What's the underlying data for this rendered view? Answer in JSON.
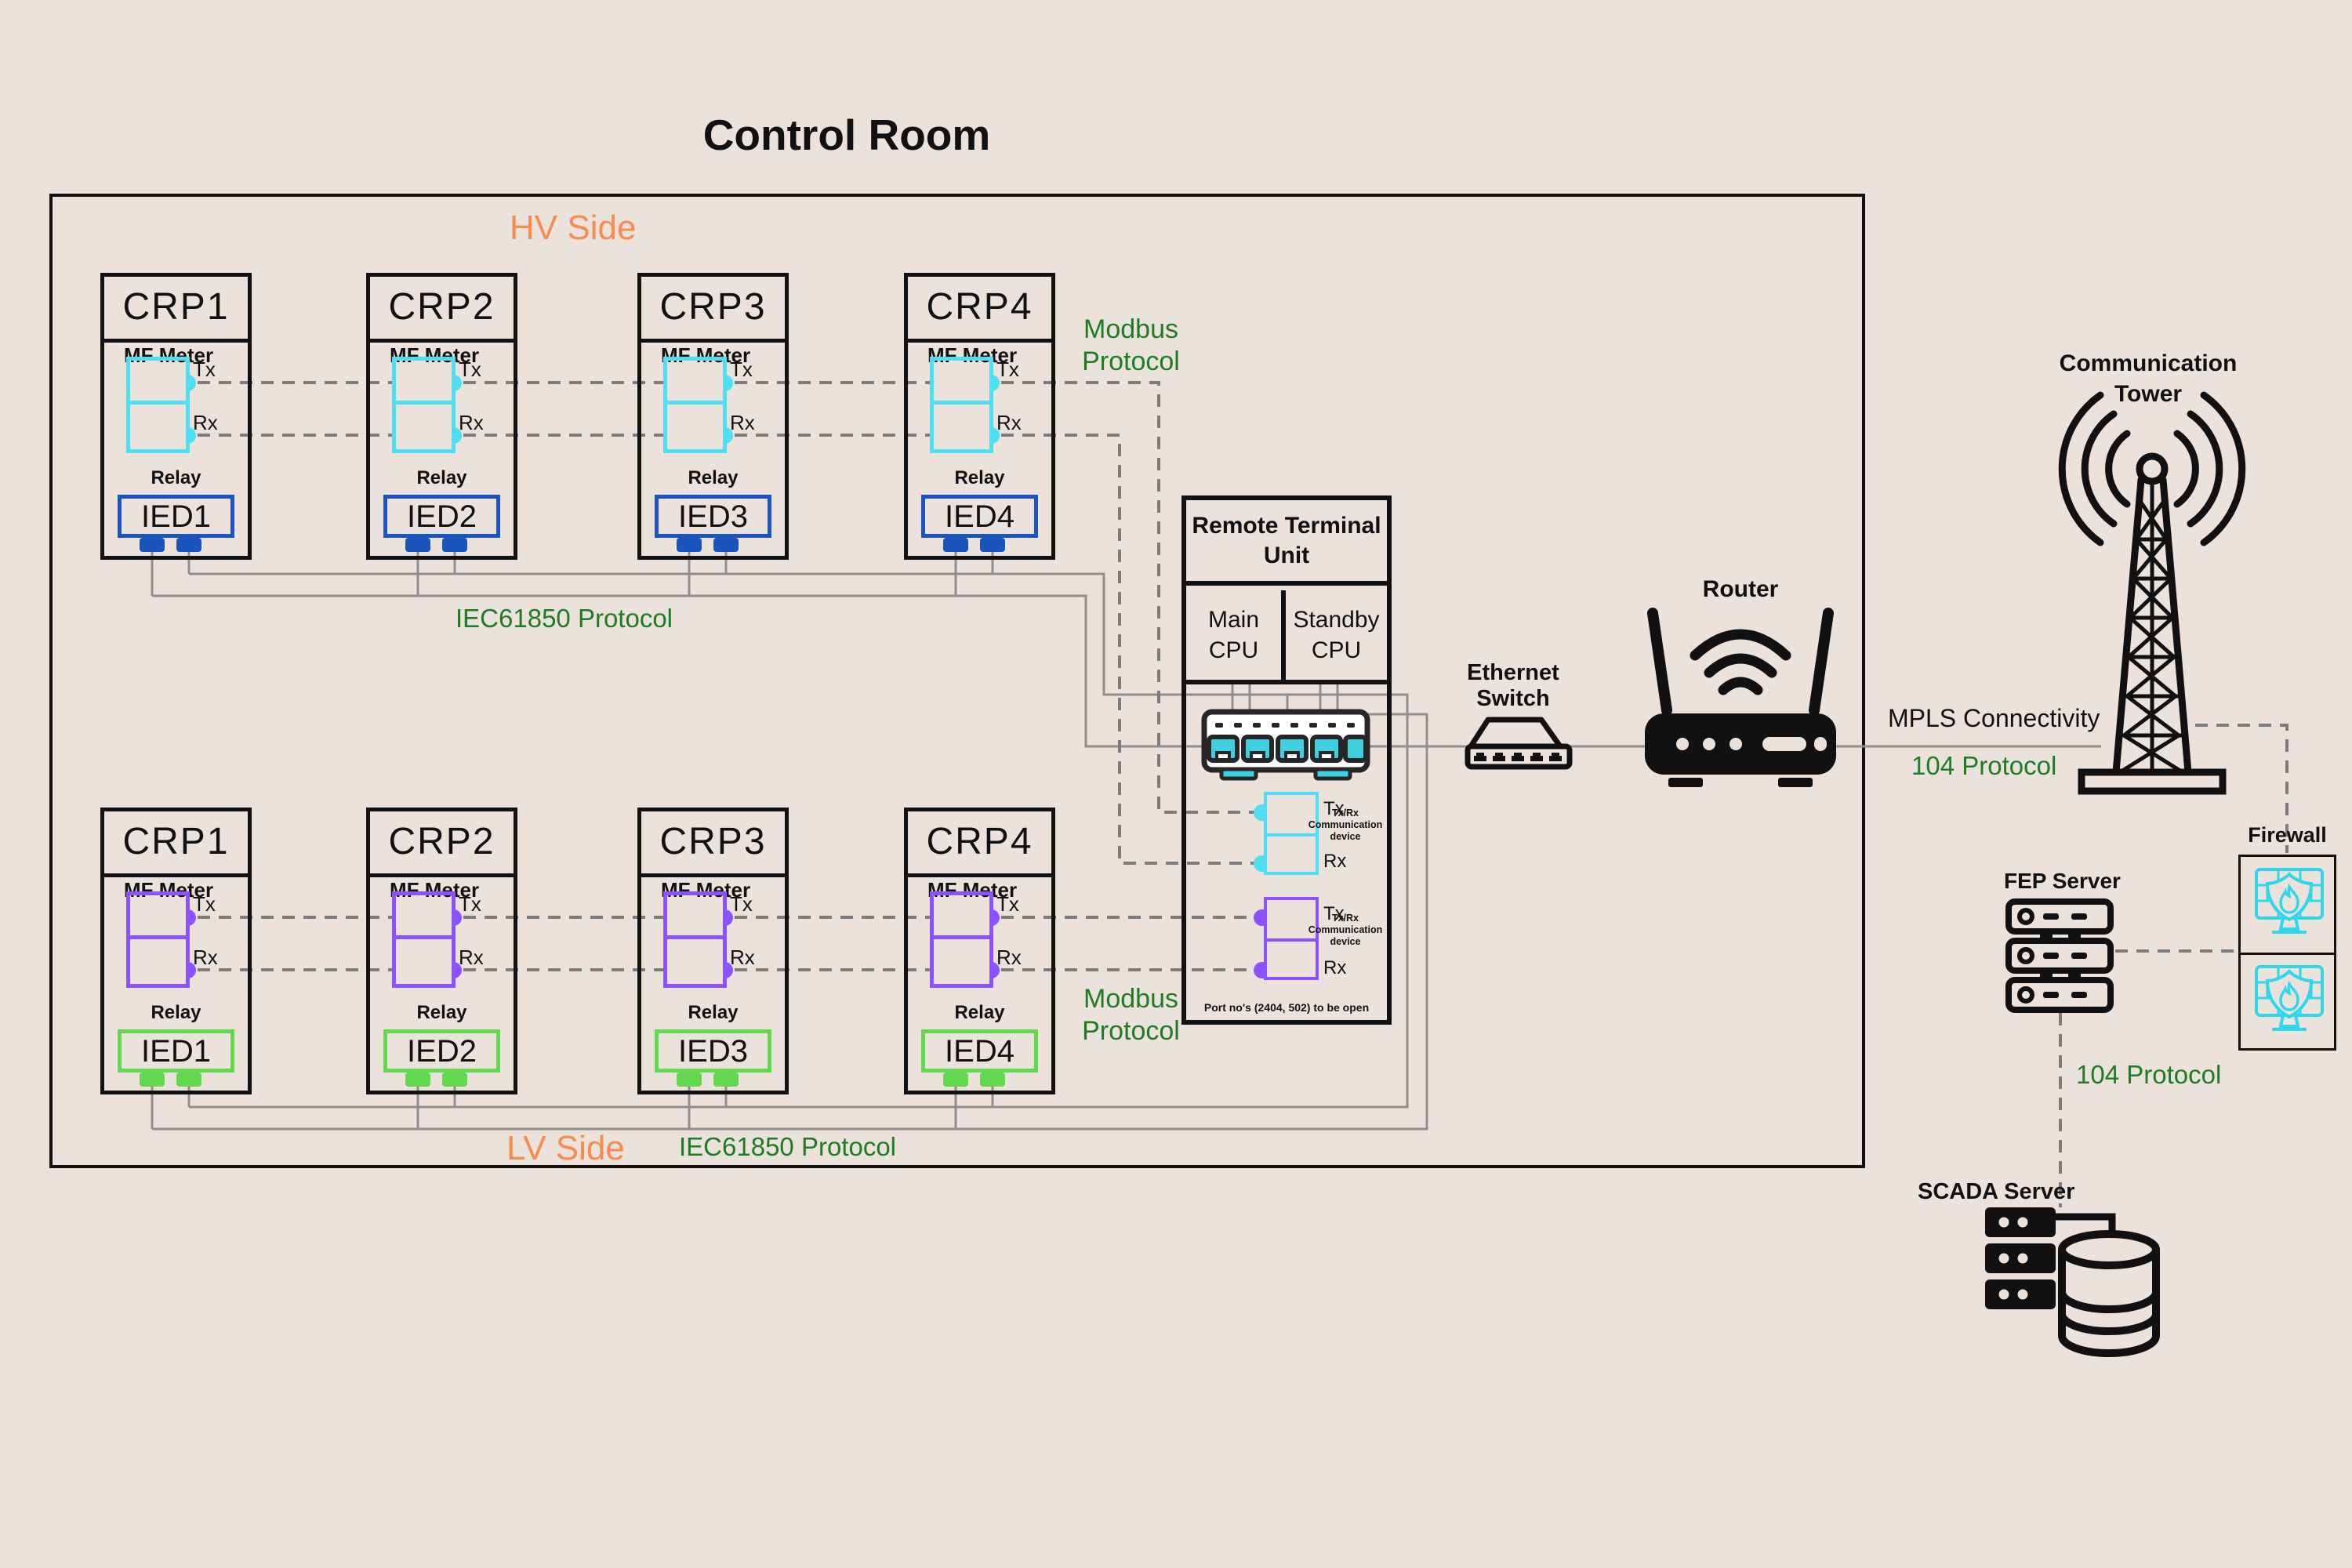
{
  "title": "Control Room",
  "sides": {
    "hv": {
      "label": "HV Side",
      "iec_label": "IEC61850 Protocol",
      "modbus_label": "Modbus Protocol",
      "meter_label": "MF Meter",
      "relay_label": "Relay",
      "tx": "Tx",
      "rx": "Rx",
      "panels": [
        {
          "title": "CRP1",
          "ied": "IED1"
        },
        {
          "title": "CRP2",
          "ied": "IED2"
        },
        {
          "title": "CRP3",
          "ied": "IED3"
        },
        {
          "title": "CRP4",
          "ied": "IED4"
        }
      ]
    },
    "lv": {
      "label": "LV Side",
      "iec_label": "IEC61850 Protocol",
      "modbus_label": "Modbus Protocol",
      "meter_label": "MF Meter",
      "relay_label": "Relay",
      "tx": "Tx",
      "rx": "Rx",
      "panels": [
        {
          "title": "CRP1",
          "ied": "IED1"
        },
        {
          "title": "CRP2",
          "ied": "IED2"
        },
        {
          "title": "CRP3",
          "ied": "IED3"
        },
        {
          "title": "CRP4",
          "ied": "IED4"
        }
      ]
    }
  },
  "rtu": {
    "title": "Remote Terminal Unit",
    "main_cpu": "Main CPU",
    "standby_cpu": "Standby CPU",
    "tx": "Tx",
    "rx": "Rx",
    "comm_device": "Tx/Rx Communication device",
    "port_note": "Port no's (2404, 502) to be open"
  },
  "network": {
    "ethernet_switch": "Ethernet Switch",
    "router": "Router",
    "tower": "Communication Tower",
    "mpls": "MPLS Connectivity",
    "protocol_104_wan": "104 Protocol",
    "firewall": "Firewall",
    "fep_server": "FEP Server",
    "protocol_104_scada": "104 Protocol",
    "scada_server": "SCADA Server"
  },
  "colors": {
    "ink": "#111111",
    "bg": "#ece2dc",
    "wire": "#8f8f8f",
    "dash": "#7d7d7d",
    "green": "#1d7c24",
    "orange": "#f68c4e",
    "cyan": "#4fdff0",
    "purple": "#8c52ff",
    "blue": "#1a54be",
    "lime": "#62d84e",
    "portcyan": "#3ecfe0",
    "fwcyan": "#2fd7ec"
  }
}
